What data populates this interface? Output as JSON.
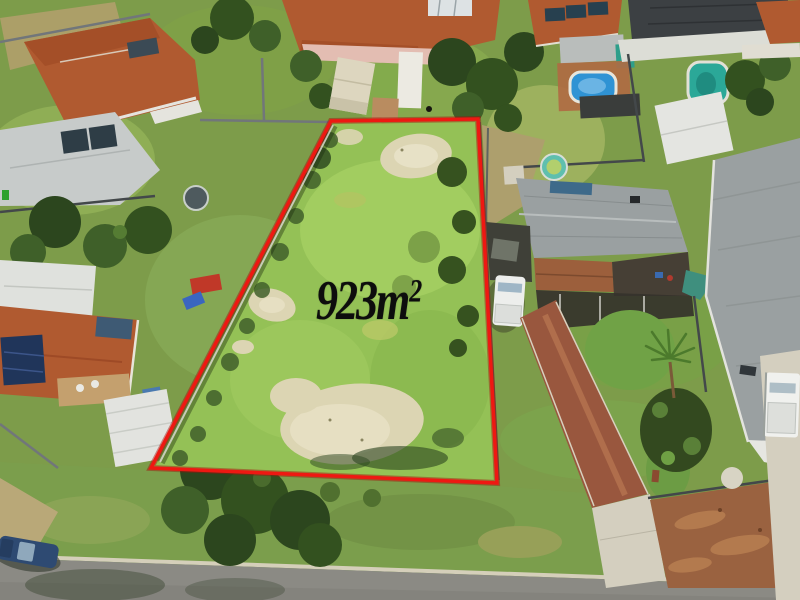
{
  "scene": {
    "type": "aerial-drone-photo",
    "subject": "vacant residential land lot outlined in red",
    "visible_objects": [
      "vacant grass lot with sand patches",
      "red boundary outline",
      "suburban houses with tiled and metal roofs",
      "two swimming pools",
      "garden sheds",
      "white van",
      "white ute",
      "blue parked car",
      "red aggregate driveway",
      "brown dirt verge patch",
      "palm tree",
      "street with concrete kerb"
    ]
  },
  "annotation": {
    "area_value": "923m",
    "area_superscript": "2"
  },
  "colors": {
    "boundary-red": "#ee1812",
    "label-black": "#0d0d0d",
    "lot-grass": "#94c156",
    "grass-base": "#7d9c4a",
    "sand": "#dcd5b3",
    "roof-orange": "#b05a30",
    "roof-grey": "#9aa0a1",
    "roof-dark": "#3c4043",
    "pool-blue": "#2f93d4",
    "road-grey": "#8b8a84",
    "dirt-brown": "#9a6240",
    "concrete": "#d4cfbf"
  }
}
